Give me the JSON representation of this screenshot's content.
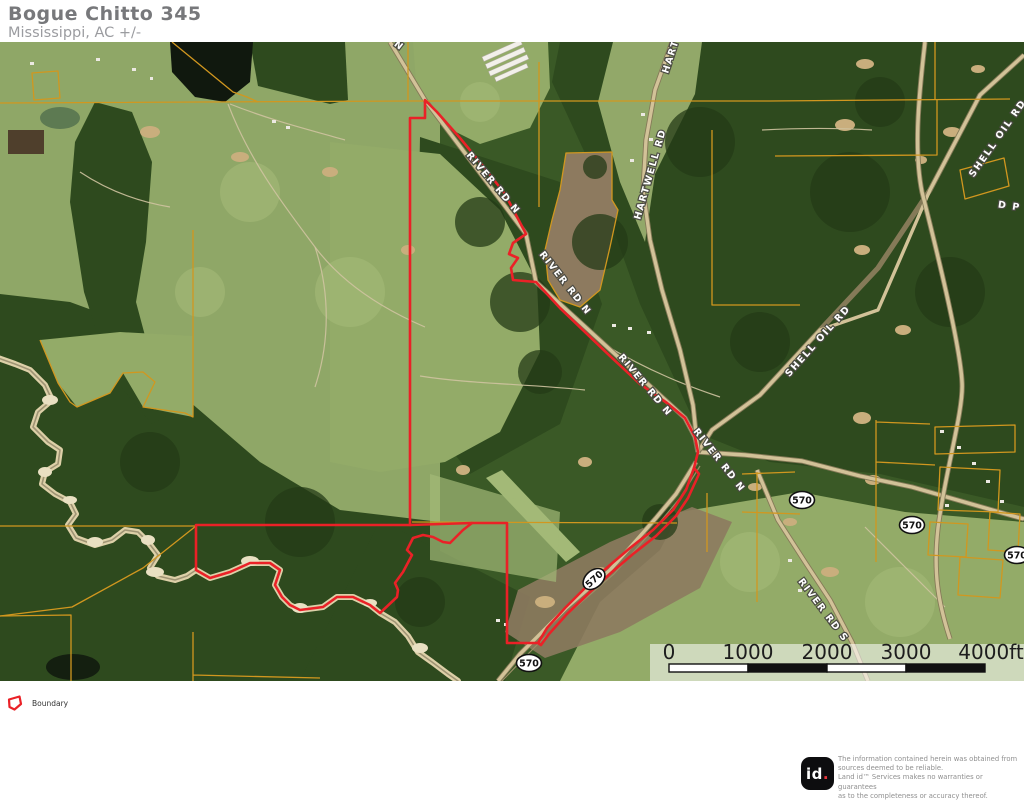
{
  "header": {
    "title": "Bogue Chitto 345",
    "subtitle": "Mississippi,  AC +/-"
  },
  "map": {
    "road_labels": [
      {
        "id": "river-rd-n-top",
        "text": "RIVER RD N"
      },
      {
        "id": "river-rd-n-1",
        "text": "RIVER RD N"
      },
      {
        "id": "river-rd-n-2",
        "text": "RIVER RD N"
      },
      {
        "id": "river-rd-n-3",
        "text": "RIVER RD N"
      },
      {
        "id": "river-rd-n-4",
        "text": "RIVER RD N"
      },
      {
        "id": "hartwell-rd-top",
        "text": "HARTWELL RD"
      },
      {
        "id": "hartwell-rd",
        "text": "HARTWELL RD"
      },
      {
        "id": "shell-oil-rd-1",
        "text": "SHELL OIL RD"
      },
      {
        "id": "shell-oil-rd-2",
        "text": "SHELL OIL RD"
      },
      {
        "id": "d-p",
        "text": "D P"
      },
      {
        "id": "river-rd-s",
        "text": "RIVER RD S"
      }
    ],
    "shields": [
      {
        "text": "570"
      },
      {
        "text": "570"
      },
      {
        "text": "570"
      },
      {
        "text": "570"
      },
      {
        "text": "570"
      }
    ],
    "scale": {
      "labels": [
        "0",
        "1000",
        "2000",
        "3000",
        "4000ft"
      ]
    }
  },
  "legend": {
    "items": [
      {
        "label": "Boundary"
      }
    ]
  },
  "footer": {
    "logo_text": "id",
    "logo_dot": ".",
    "disclaimer_lines": [
      "The information contained herein was obtained from",
      "sources deemed to be reliable.",
      "Land id™ Services makes no warranties or guarantees",
      "as to the completeness or accuracy thereof."
    ]
  },
  "colors": {
    "boundary": "#ea2127",
    "parcel_line": "#d1971f",
    "title_text": "#77787b",
    "subtitle_text": "#9b9ca0",
    "accent_dot": "#e8353c",
    "shield_text": "#111111"
  }
}
